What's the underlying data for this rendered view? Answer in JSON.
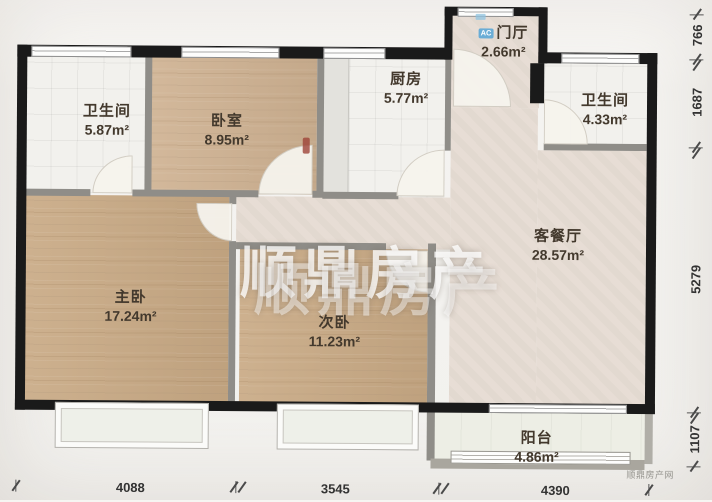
{
  "watermark": {
    "main": "顺鼎房产",
    "echo": "顺鼎房产",
    "corner": "顺鼎房产网"
  },
  "badges": {
    "ac": "AC"
  },
  "rooms": {
    "bath1": {
      "name": "卫生间",
      "area": "5.87m²"
    },
    "bedroom": {
      "name": "卧室",
      "area": "8.95m²"
    },
    "kitchen": {
      "name": "厨房",
      "area": "5.77m²"
    },
    "foyer": {
      "name": "门厅",
      "area": "2.66m²"
    },
    "bath2": {
      "name": "卫生间",
      "area": "4.33m²"
    },
    "living": {
      "name": "客餐厅",
      "area": "28.57m²"
    },
    "master": {
      "name": "主卧",
      "area": "17.24m²"
    },
    "second": {
      "name": "次卧",
      "area": "11.23m²"
    },
    "balcony": {
      "name": "阳台",
      "area": "4.86m²"
    }
  },
  "dimensions": {
    "right": [
      "766",
      "1687",
      "5279",
      "1107"
    ],
    "bottom": [
      "4088",
      "3545",
      "4390"
    ]
  },
  "colors": {
    "exterior_wall": "#1a1a1a",
    "partition_wall": "#8f8d88",
    "wood_floor": "#c9aa85",
    "tile_floor": "#f2f1ed",
    "living_floor": "#e6dcd3",
    "balcony_floor": "#edeee5",
    "watermark": "#ffffff"
  }
}
